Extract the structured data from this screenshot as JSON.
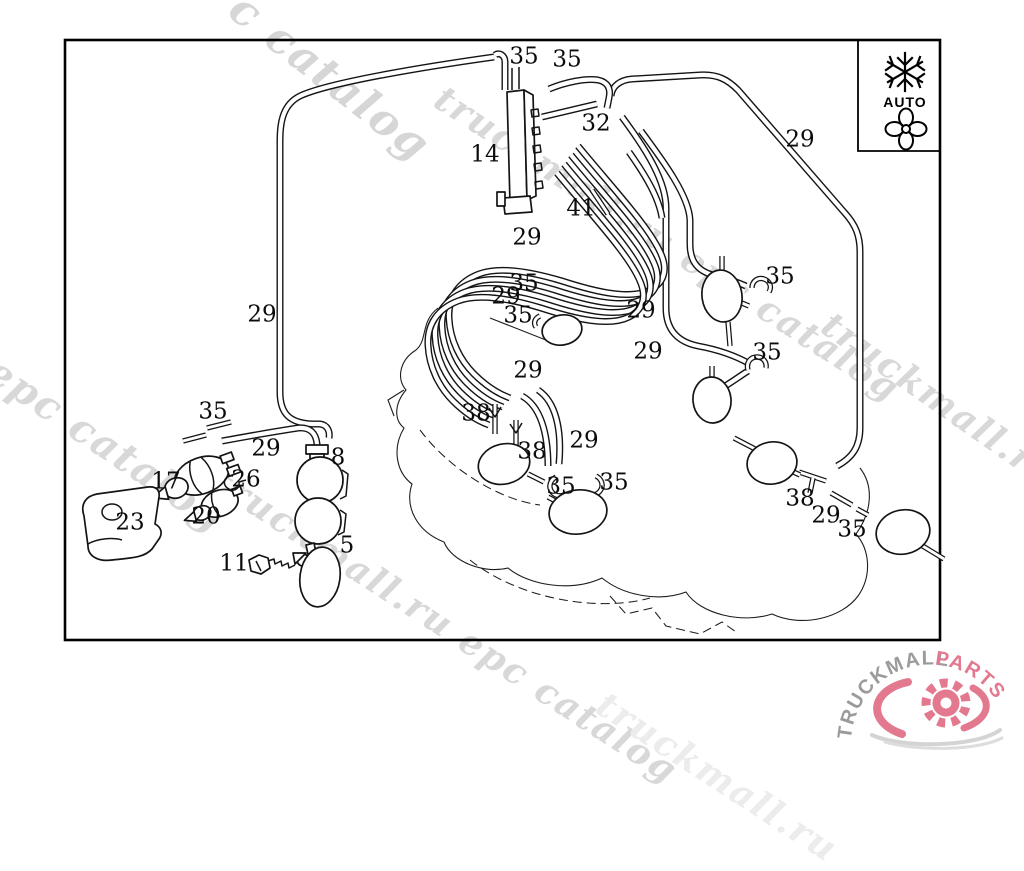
{
  "document": {
    "kind": "vacuum-line parts diagram"
  },
  "climate_panel": {
    "auto_label": "AUTO",
    "snowflake_icon": "snowflake",
    "fan_icon": "fan"
  },
  "part_labels": [
    {
      "text": "35",
      "x": 524,
      "y": 57
    },
    {
      "text": "35",
      "x": 567,
      "y": 60
    },
    {
      "text": "32",
      "x": 596,
      "y": 124
    },
    {
      "text": "14",
      "x": 485,
      "y": 155
    },
    {
      "text": "29",
      "x": 800,
      "y": 140
    },
    {
      "text": "41",
      "x": 581,
      "y": 209
    },
    {
      "text": "29",
      "x": 527,
      "y": 238
    },
    {
      "text": "35",
      "x": 524,
      "y": 284
    },
    {
      "text": "29",
      "x": 506,
      "y": 297
    },
    {
      "text": "35",
      "x": 518,
      "y": 316
    },
    {
      "text": "29",
      "x": 641,
      "y": 311
    },
    {
      "text": "35",
      "x": 780,
      "y": 277
    },
    {
      "text": "29",
      "x": 648,
      "y": 352
    },
    {
      "text": "35",
      "x": 767,
      "y": 353
    },
    {
      "text": "29",
      "x": 262,
      "y": 315
    },
    {
      "text": "29",
      "x": 528,
      "y": 371
    },
    {
      "text": "38",
      "x": 476,
      "y": 414
    },
    {
      "text": "35",
      "x": 213,
      "y": 412
    },
    {
      "text": "29",
      "x": 584,
      "y": 441
    },
    {
      "text": "38",
      "x": 532,
      "y": 452
    },
    {
      "text": "29",
      "x": 266,
      "y": 449
    },
    {
      "text": "8",
      "x": 338,
      "y": 458
    },
    {
      "text": "17",
      "x": 166,
      "y": 482
    },
    {
      "text": "26",
      "x": 246,
      "y": 480
    },
    {
      "text": "20",
      "x": 206,
      "y": 517
    },
    {
      "text": "23",
      "x": 130,
      "y": 523
    },
    {
      "text": "35",
      "x": 561,
      "y": 487
    },
    {
      "text": "35",
      "x": 614,
      "y": 483
    },
    {
      "text": "5",
      "x": 347,
      "y": 546
    },
    {
      "text": "11",
      "x": 234,
      "y": 564
    },
    {
      "text": "38",
      "x": 800,
      "y": 499
    },
    {
      "text": "29",
      "x": 826,
      "y": 516
    },
    {
      "text": "35",
      "x": 852,
      "y": 530
    }
  ],
  "watermarks": [
    {
      "text": "c catalog",
      "x": 248,
      "y": -14,
      "rot": 38,
      "size": 44,
      "color": "#d6d6d6"
    },
    {
      "text": "truckmall.ru epc catalog",
      "x": 448,
      "y": 80,
      "rot": 33,
      "size": 36,
      "color": "#d8d8d8"
    },
    {
      "text": "truckmall.ru e",
      "x": 836,
      "y": 306,
      "rot": 35,
      "size": 36,
      "color": "#d8d8d8"
    },
    {
      "text": "l epc catalog",
      "x": -26,
      "y": 332,
      "rot": 34,
      "size": 40,
      "color": "#d8d8d8"
    },
    {
      "text": "truckmall.ru epc catalog",
      "x": 226,
      "y": 462,
      "rot": 33,
      "size": 36,
      "color": "#d8d8d8"
    },
    {
      "text": "truckmall.ru",
      "x": 610,
      "y": 686,
      "rot": 33,
      "size": 36,
      "color": "#ececec"
    }
  ],
  "logo": {
    "name_gray": "TRUCKMALL",
    "name_pink": "PARTS",
    "gray": "#9b9b9b",
    "pink": "#e2798f"
  }
}
